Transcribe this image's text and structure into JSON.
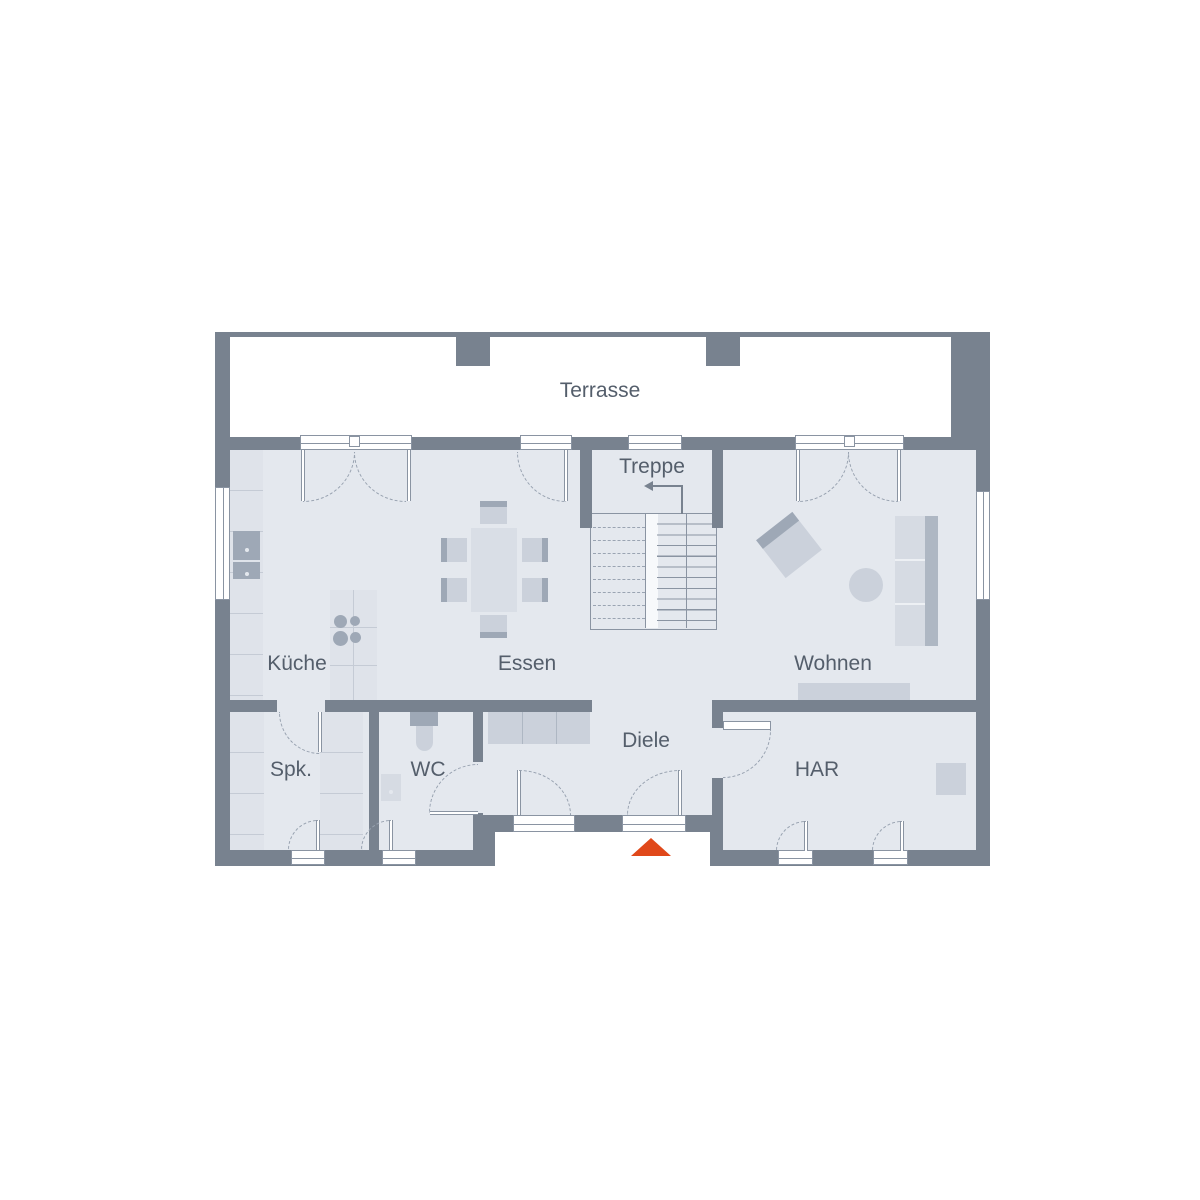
{
  "floorplan": {
    "rooms": [
      {
        "id": "terrasse",
        "label": "Terrasse"
      },
      {
        "id": "treppe",
        "label": "Treppe"
      },
      {
        "id": "kueche",
        "label": "Küche"
      },
      {
        "id": "essen",
        "label": "Essen"
      },
      {
        "id": "wohnen",
        "label": "Wohnen"
      },
      {
        "id": "spk",
        "label": "Spk."
      },
      {
        "id": "wc",
        "label": "WC"
      },
      {
        "id": "diele",
        "label": "Diele"
      },
      {
        "id": "har",
        "label": "HAR"
      }
    ],
    "icons": {
      "entrance": "up-triangle-arrow",
      "stair_direction": "left-turn-arrow"
    },
    "colors": {
      "wall": "#78828F",
      "floor": "#E4E8EE",
      "furniture_light": "#D6DBE3",
      "furniture_dark": "#9EA8B6",
      "entrance_arrow": "#E0481A",
      "label_text": "#545E6B"
    }
  }
}
